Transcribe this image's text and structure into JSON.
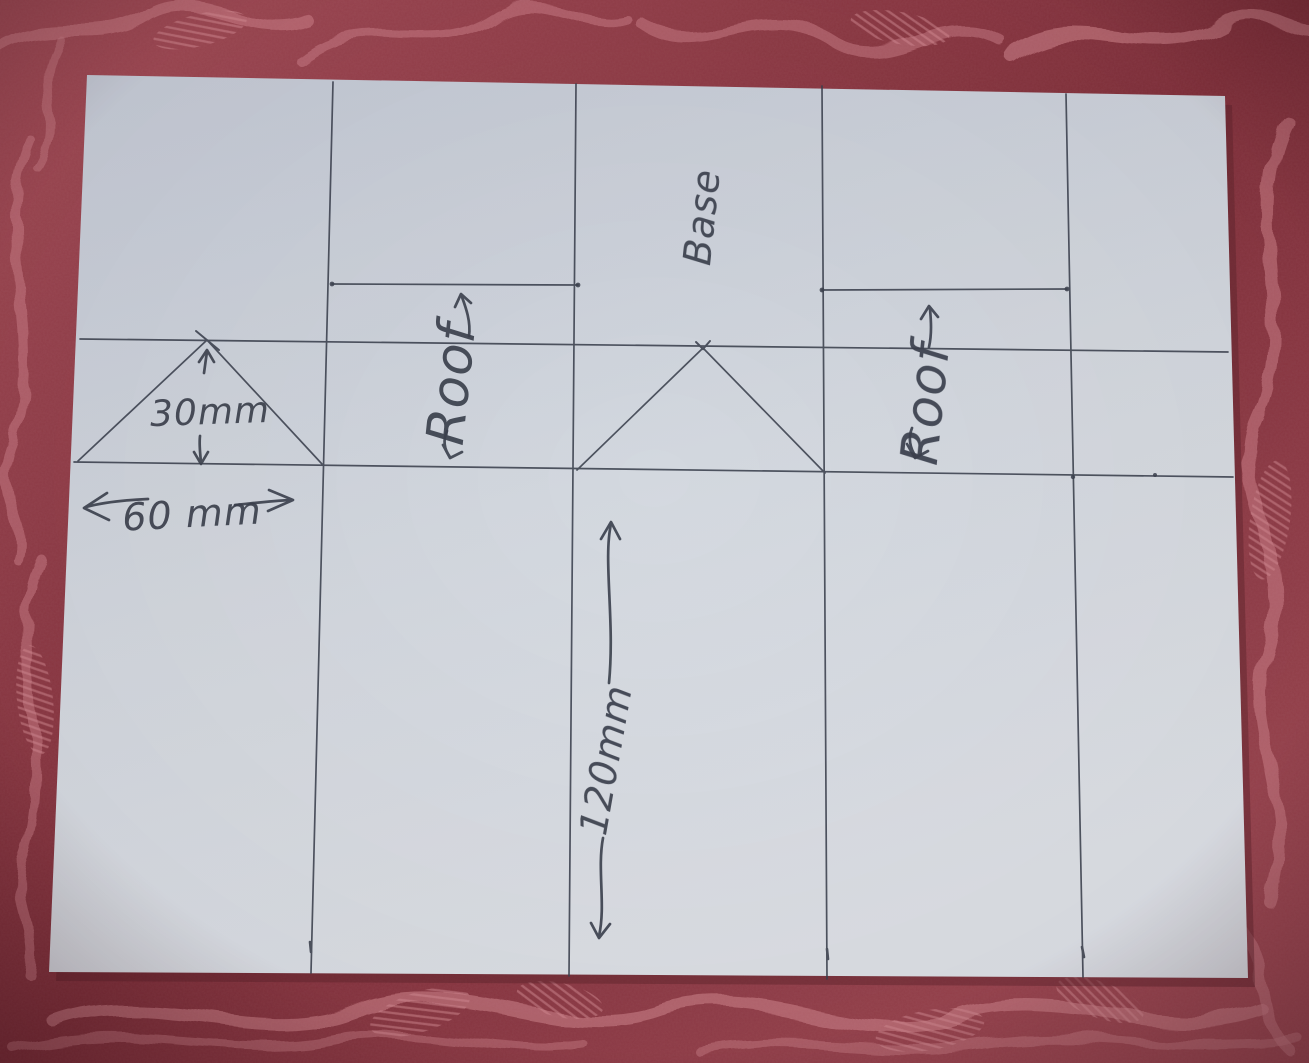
{
  "scene": {
    "type": "photograph",
    "subject": "hand-drawn card net for a house-shaped model",
    "surface": "rose damask tablecloth"
  },
  "colors": {
    "fabric_base": "#a24b56",
    "fabric_dark": "#802f3a",
    "fabric_highlight": "#cd8089",
    "fabric_highlight2": "#d9959b",
    "paper_top": "#c5cbd6",
    "paper_mid": "#d3d8df",
    "paper_bottom": "#dde1e7",
    "ink": "#3b414e",
    "shadow": "#5e232c"
  },
  "annotations": {
    "base_label": {
      "text": "Base"
    },
    "roof_left_label": {
      "text": "Roof"
    },
    "roof_right_label": {
      "text": "Roof"
    },
    "gable_height_label": {
      "text": "30mm"
    },
    "gable_width_label": {
      "text": "60 mm"
    },
    "panel_length_label": {
      "text": "120mm"
    }
  }
}
